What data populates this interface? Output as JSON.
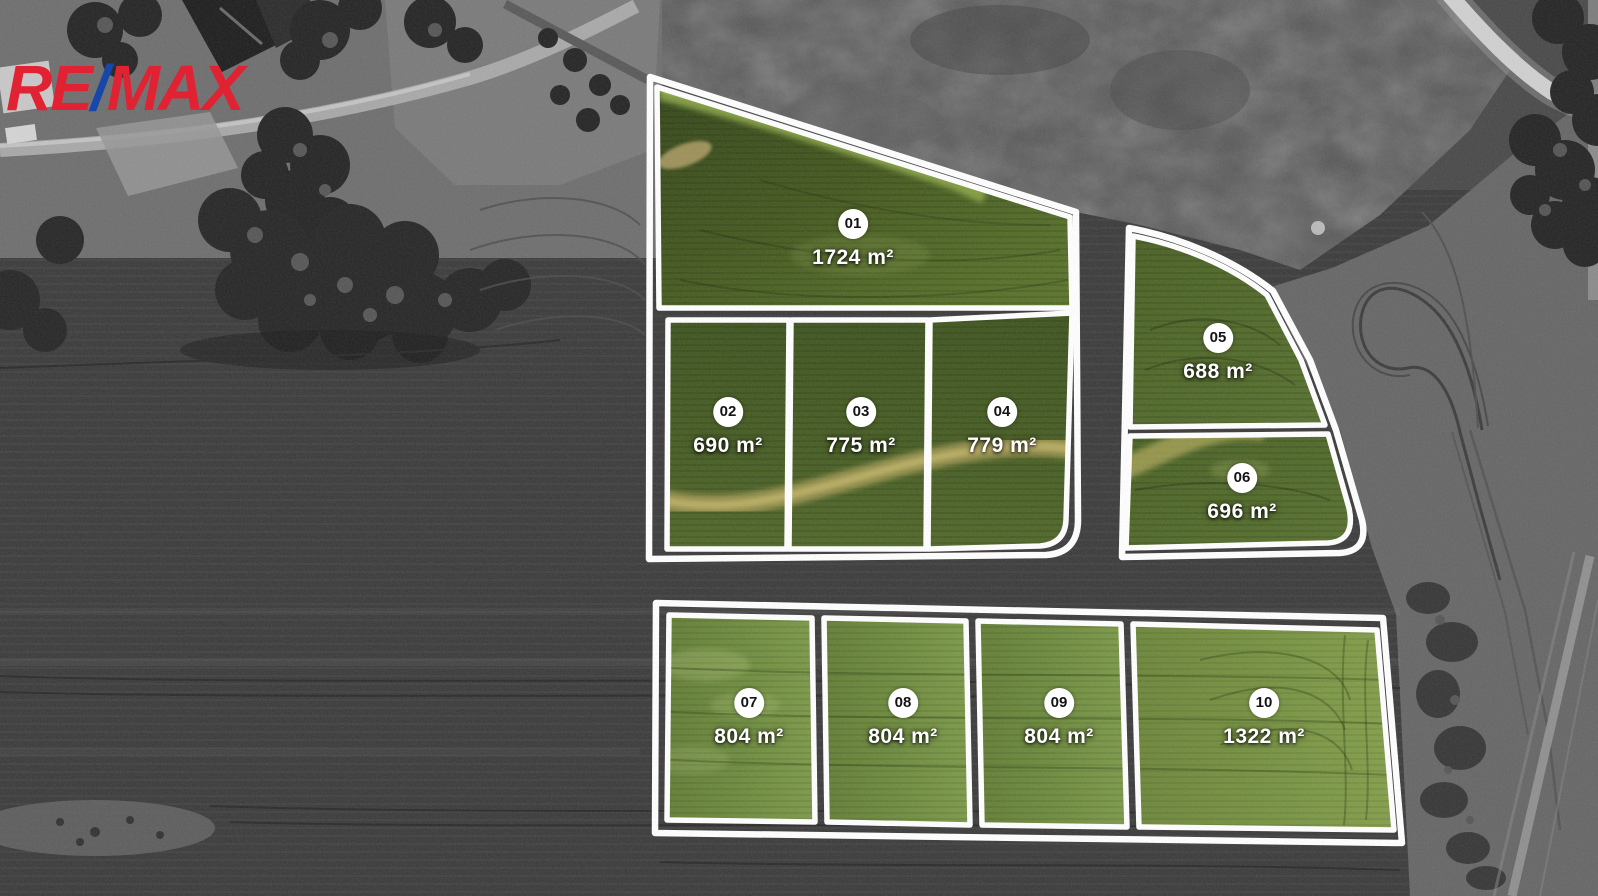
{
  "logo": {
    "re": "RE",
    "slash": "/",
    "max": "MAX"
  },
  "plots": [
    {
      "id": "01",
      "area": "1724 m²"
    },
    {
      "id": "02",
      "area": "690 m²"
    },
    {
      "id": "03",
      "area": "775 m²"
    },
    {
      "id": "04",
      "area": "779 m²"
    },
    {
      "id": "05",
      "area": "688 m²"
    },
    {
      "id": "06",
      "area": "696 m²"
    },
    {
      "id": "07",
      "area": "804 m²"
    },
    {
      "id": "08",
      "area": "804 m²"
    },
    {
      "id": "09",
      "area": "804 m²"
    },
    {
      "id": "10",
      "area": "1322 m²"
    }
  ],
  "colors": {
    "logo_red": "#e02233",
    "logo_blue": "#1747ab",
    "plot_outline": "#ffffff",
    "badge_background": "#ffffff",
    "badge_text": "#141414",
    "area_text": "#ffffff"
  }
}
